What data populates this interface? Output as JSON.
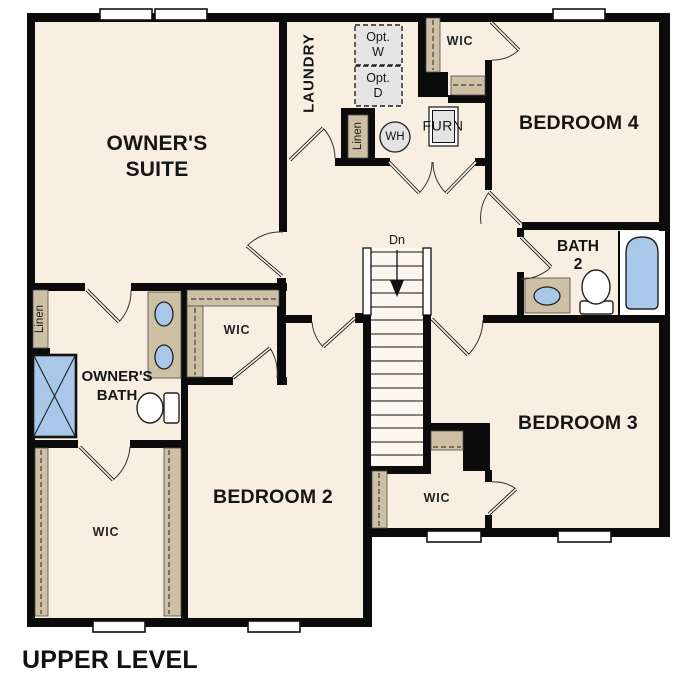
{
  "title": "UPPER LEVEL",
  "colors": {
    "wall": "#0b0b0b",
    "floor": "#f8efe2",
    "shelf_tan": "#cdc0a5",
    "fixture_blue": "#a9c7e8",
    "option_gray": "#e4e4e4",
    "window_white": "#ffffff"
  },
  "rooms": {
    "owners_suite": {
      "line1": "OWNER'S",
      "line2": "SUITE"
    },
    "laundry": {
      "label": "LAUNDRY"
    },
    "bedroom2": {
      "label": "BEDROOM 2"
    },
    "bedroom3": {
      "label": "BEDROOM 3"
    },
    "bedroom4": {
      "label": "BEDROOM 4"
    },
    "bath2": {
      "line1": "BATH",
      "line2": "2"
    },
    "owners_bath": {
      "line1": "OWNER'S",
      "line2": "BATH"
    },
    "wic_bedroom4": {
      "label": "WIC"
    },
    "wic_bedroom2": {
      "label": "WIC"
    },
    "wic_owners": {
      "label": "WIC"
    },
    "wic_bedroom3": {
      "label": "WIC"
    }
  },
  "closets": {
    "linen_hall": {
      "label": "Linen"
    },
    "linen_bath": {
      "label": "Linen"
    }
  },
  "fixtures": {
    "washer_optional": {
      "line1": "Opt.",
      "line2": "W"
    },
    "dryer_optional": {
      "line1": "Opt.",
      "line2": "D"
    },
    "water_heater": {
      "label": "WH"
    },
    "furnace": {
      "label": "FURN"
    }
  },
  "stairs": {
    "direction_label": "Dn"
  }
}
